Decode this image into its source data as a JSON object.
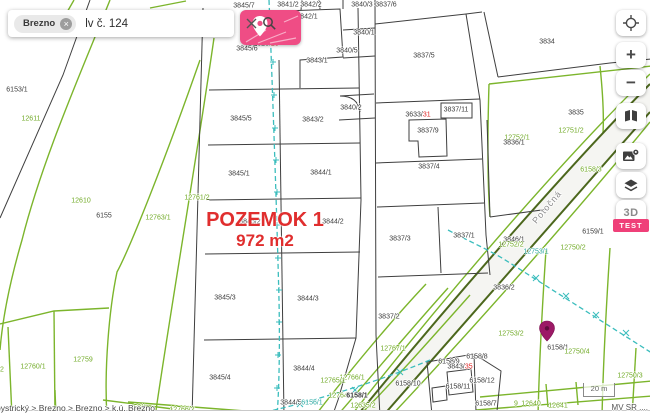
{
  "search": {
    "chip_label": "Brezno",
    "query": "lv č. 124"
  },
  "toolbar": {
    "zoom_in_label": "+",
    "zoom_out_label": "−",
    "three_d_label": "3D",
    "test_badge_label": "TEST"
  },
  "overlay": {
    "parcel_title": "POZEMOK 1",
    "parcel_area": "972 m2"
  },
  "footer": {
    "breadcrumb": "bystrický > Brezno > Brezno > k.ú. Brezno",
    "attribution": "MV SR ....",
    "scale_label": "20 m"
  },
  "colors": {
    "black": "#3c3c3c",
    "green": "#72ab28",
    "teal": "#2fa9a2",
    "red": "#e02424",
    "gray": "#8c8c8c"
  },
  "map_labels": [
    {
      "t": "3845/7",
      "x": 244,
      "y": 6,
      "c": "black"
    },
    {
      "t": "3841/2",
      "x": 288,
      "y": 5,
      "c": "black"
    },
    {
      "t": "3842/2",
      "x": 311,
      "y": 5,
      "c": "black"
    },
    {
      "t": "3842/1",
      "x": 307,
      "y": 17,
      "c": "black"
    },
    {
      "t": "3840/3",
      "x": 362,
      "y": 5,
      "c": "black"
    },
    {
      "t": "3837/6",
      "x": 386,
      "y": 5,
      "c": "black"
    },
    {
      "t": "3840/1",
      "x": 364,
      "y": 33,
      "c": "black"
    },
    {
      "t": "3840/5",
      "x": 347,
      "y": 51,
      "c": "black"
    },
    {
      "t": "3845/6",
      "x": 247,
      "y": 49,
      "c": "black"
    },
    {
      "parts": [
        {
          "t": "1626/",
          "c": "black"
        },
        {
          "t": "23",
          "c": "red"
        }
      ],
      "x": 266,
      "y": 44
    },
    {
      "t": "3843/1",
      "x": 317,
      "y": 61,
      "c": "black"
    },
    {
      "t": "3837/5",
      "x": 424,
      "y": 56,
      "c": "black"
    },
    {
      "t": "3840/2",
      "x": 351,
      "y": 108,
      "c": "black"
    },
    {
      "t": "3843/2",
      "x": 313,
      "y": 120,
      "c": "black"
    },
    {
      "t": "3845/5",
      "x": 241,
      "y": 119,
      "c": "black"
    },
    {
      "t": "3837/11",
      "x": 456,
      "y": 110,
      "c": "black"
    },
    {
      "parts": [
        {
          "t": "3633/",
          "c": "black"
        },
        {
          "t": "31",
          "c": "red"
        }
      ],
      "x": 418,
      "y": 115
    },
    {
      "t": "3837/9",
      "x": 428,
      "y": 131,
      "c": "black"
    },
    {
      "t": "3837/4",
      "x": 429,
      "y": 167,
      "c": "black"
    },
    {
      "t": "3845/1",
      "x": 239,
      "y": 174,
      "c": "black"
    },
    {
      "t": "3844/1",
      "x": 321,
      "y": 173,
      "c": "black"
    },
    {
      "t": "3845/2",
      "x": 250,
      "y": 222,
      "c": "black"
    },
    {
      "t": "3844/2",
      "x": 333,
      "y": 222,
      "c": "black"
    },
    {
      "t": "3837/3",
      "x": 400,
      "y": 239,
      "c": "black"
    },
    {
      "t": "3837/1",
      "x": 464,
      "y": 236,
      "c": "black"
    },
    {
      "t": "3837/2",
      "x": 389,
      "y": 317,
      "c": "black"
    },
    {
      "t": "3845/3",
      "x": 225,
      "y": 298,
      "c": "black"
    },
    {
      "t": "3844/3",
      "x": 308,
      "y": 299,
      "c": "black"
    },
    {
      "t": "3845/4",
      "x": 220,
      "y": 378,
      "c": "black"
    },
    {
      "t": "3844/4",
      "x": 304,
      "y": 369,
      "c": "black"
    },
    {
      "t": "3844/5",
      "x": 291,
      "y": 403,
      "c": "black"
    },
    {
      "t": "6156/1",
      "x": 312,
      "y": 403,
      "c": "teal"
    },
    {
      "t": "6153/1",
      "x": 17,
      "y": 90,
      "c": "black"
    },
    {
      "t": "12611",
      "x": 31,
      "y": 119,
      "c": "green"
    },
    {
      "t": "12610",
      "x": 81,
      "y": 201,
      "c": "green"
    },
    {
      "t": "6155",
      "x": 104,
      "y": 216,
      "c": "black"
    },
    {
      "t": "12763/1",
      "x": 158,
      "y": 218,
      "c": "green"
    },
    {
      "t": "12761/2",
      "x": 197,
      "y": 198,
      "c": "green"
    },
    {
      "t": "12760/1",
      "x": 33,
      "y": 367,
      "c": "green"
    },
    {
      "t": "12759",
      "x": 83,
      "y": 360,
      "c": "green"
    },
    {
      "t": "2",
      "x": 2,
      "y": 370,
      "c": "green"
    },
    {
      "t": "58/1",
      "x": 140,
      "y": 408,
      "c": "green"
    },
    {
      "t": "12766/2",
      "x": 182,
      "y": 410,
      "c": "green"
    },
    {
      "t": "3834",
      "x": 547,
      "y": 42,
      "c": "black"
    },
    {
      "t": "3835",
      "x": 576,
      "y": 113,
      "c": "black"
    },
    {
      "t": "12751/2",
      "x": 571,
      "y": 131,
      "c": "green"
    },
    {
      "t": "12752/1",
      "x": 517,
      "y": 138,
      "c": "green"
    },
    {
      "t": "3836/1",
      "x": 514,
      "y": 143,
      "c": "black"
    },
    {
      "t": "6158/3",
      "x": 591,
      "y": 170,
      "c": "green"
    },
    {
      "t": "Potočná",
      "x": 547,
      "y": 207,
      "c": "gray",
      "fs": 9,
      "rot": -50,
      "sp": 1
    },
    {
      "t": "6159/1",
      "x": 593,
      "y": 232,
      "c": "black"
    },
    {
      "t": "12750/2",
      "x": 573,
      "y": 248,
      "c": "green"
    },
    {
      "t": "3846/1",
      "x": 514,
      "y": 240,
      "c": "black"
    },
    {
      "t": "12752/2",
      "x": 511,
      "y": 245,
      "c": "green"
    },
    {
      "t": "12753/1",
      "x": 536,
      "y": 252,
      "c": "teal"
    },
    {
      "t": "3836/2",
      "x": 504,
      "y": 288,
      "c": "black"
    },
    {
      "t": "12753/2",
      "x": 511,
      "y": 334,
      "c": "green"
    },
    {
      "t": "6158/1",
      "x": 558,
      "y": 348,
      "c": "black"
    },
    {
      "t": "12750/4",
      "x": 577,
      "y": 352,
      "c": "green"
    },
    {
      "t": "12750/3",
      "x": 630,
      "y": 376,
      "c": "green"
    },
    {
      "t": "12767/1",
      "x": 393,
      "y": 349,
      "c": "green"
    },
    {
      "t": "12766/1",
      "x": 352,
      "y": 378,
      "c": "green"
    },
    {
      "t": "12765/1",
      "x": 333,
      "y": 381,
      "c": "green"
    },
    {
      "t": "12764/1",
      "x": 341,
      "y": 396,
      "c": "green"
    },
    {
      "t": "6158/1",
      "x": 357,
      "y": 396,
      "c": "black",
      "b": true
    },
    {
      "t": "12635/2",
      "x": 363,
      "y": 406,
      "c": "green"
    },
    {
      "t": "6158/10",
      "x": 408,
      "y": 384,
      "c": "black"
    },
    {
      "t": "6158/11",
      "x": 458,
      "y": 387,
      "c": "black"
    },
    {
      "t": "6158/12",
      "x": 482,
      "y": 381,
      "c": "black"
    },
    {
      "t": "6158/9",
      "x": 449,
      "y": 362,
      "c": "black"
    },
    {
      "t": "6158/8",
      "x": 477,
      "y": 357,
      "c": "black"
    },
    {
      "parts": [
        {
          "t": "3843/",
          "c": "black"
        },
        {
          "t": "35",
          "c": "red"
        }
      ],
      "x": 460,
      "y": 367
    },
    {
      "t": "6158/7",
      "x": 486,
      "y": 404,
      "c": "black"
    },
    {
      "t": "9",
      "x": 516,
      "y": 404,
      "c": "green"
    },
    {
      "t": "12640",
      "x": 531,
      "y": 404,
      "c": "green"
    },
    {
      "t": "12641",
      "x": 558,
      "y": 406,
      "c": "green"
    }
  ]
}
